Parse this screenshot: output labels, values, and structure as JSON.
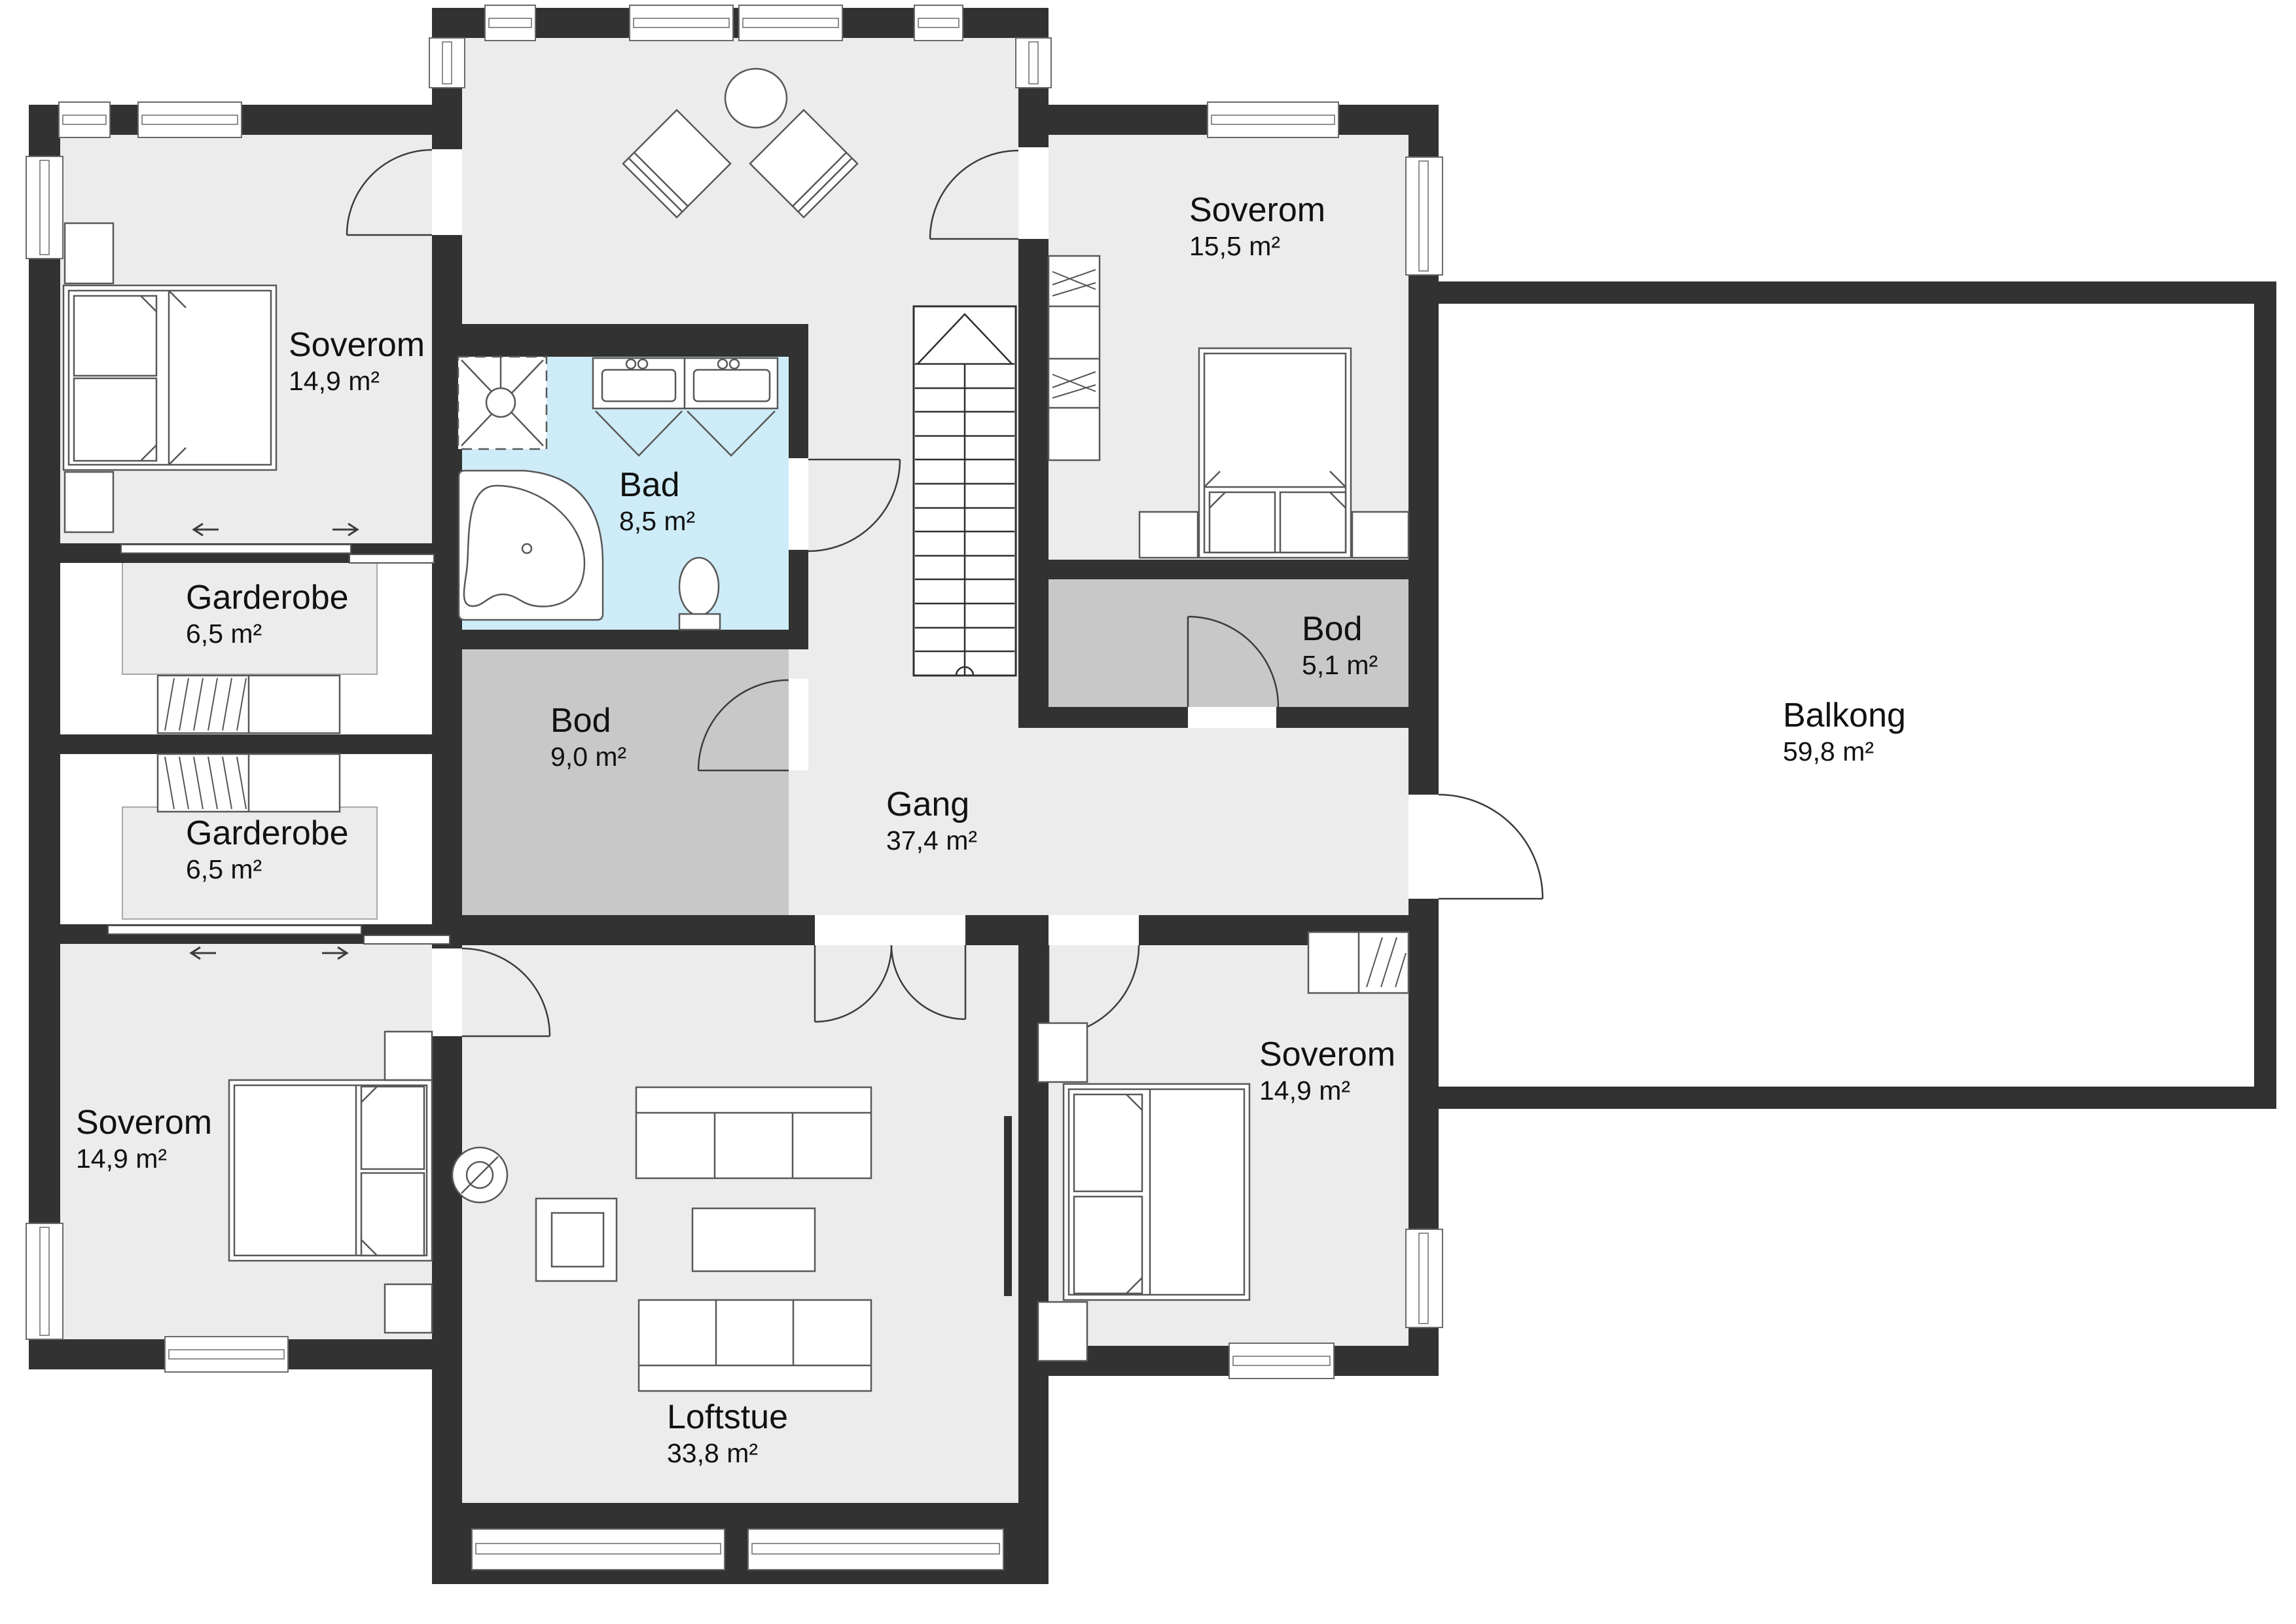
{
  "colors": {
    "wall": "#323232",
    "floor": "#ececec",
    "bathroom": "#cdecf8",
    "storage": "#c8c8c8",
    "text": "#111111"
  },
  "rooms": [
    {
      "id": "soverom-nw",
      "name": "Soverom",
      "area": "14,9 m²"
    },
    {
      "id": "bad",
      "name": "Bad",
      "area": "8,5 m²"
    },
    {
      "id": "soverom-ne",
      "name": "Soverom",
      "area": "15,5 m²"
    },
    {
      "id": "garderobe-n",
      "name": "Garderobe",
      "area": "6,5 m²"
    },
    {
      "id": "bod-9",
      "name": "Bod",
      "area": "9,0 m²"
    },
    {
      "id": "bod-5",
      "name": "Bod",
      "area": "5,1 m²"
    },
    {
      "id": "garderobe-s",
      "name": "Garderobe",
      "area": "6,5 m²"
    },
    {
      "id": "gang",
      "name": "Gang",
      "area": "37,4 m²"
    },
    {
      "id": "balkong",
      "name": "Balkong",
      "area": "59,8 m²"
    },
    {
      "id": "soverom-sw",
      "name": "Soverom",
      "area": "14,9 m²"
    },
    {
      "id": "loftstue",
      "name": "Loftstue",
      "area": "33,8 m²"
    },
    {
      "id": "soverom-se",
      "name": "Soverom",
      "area": "14,9 m²"
    }
  ]
}
